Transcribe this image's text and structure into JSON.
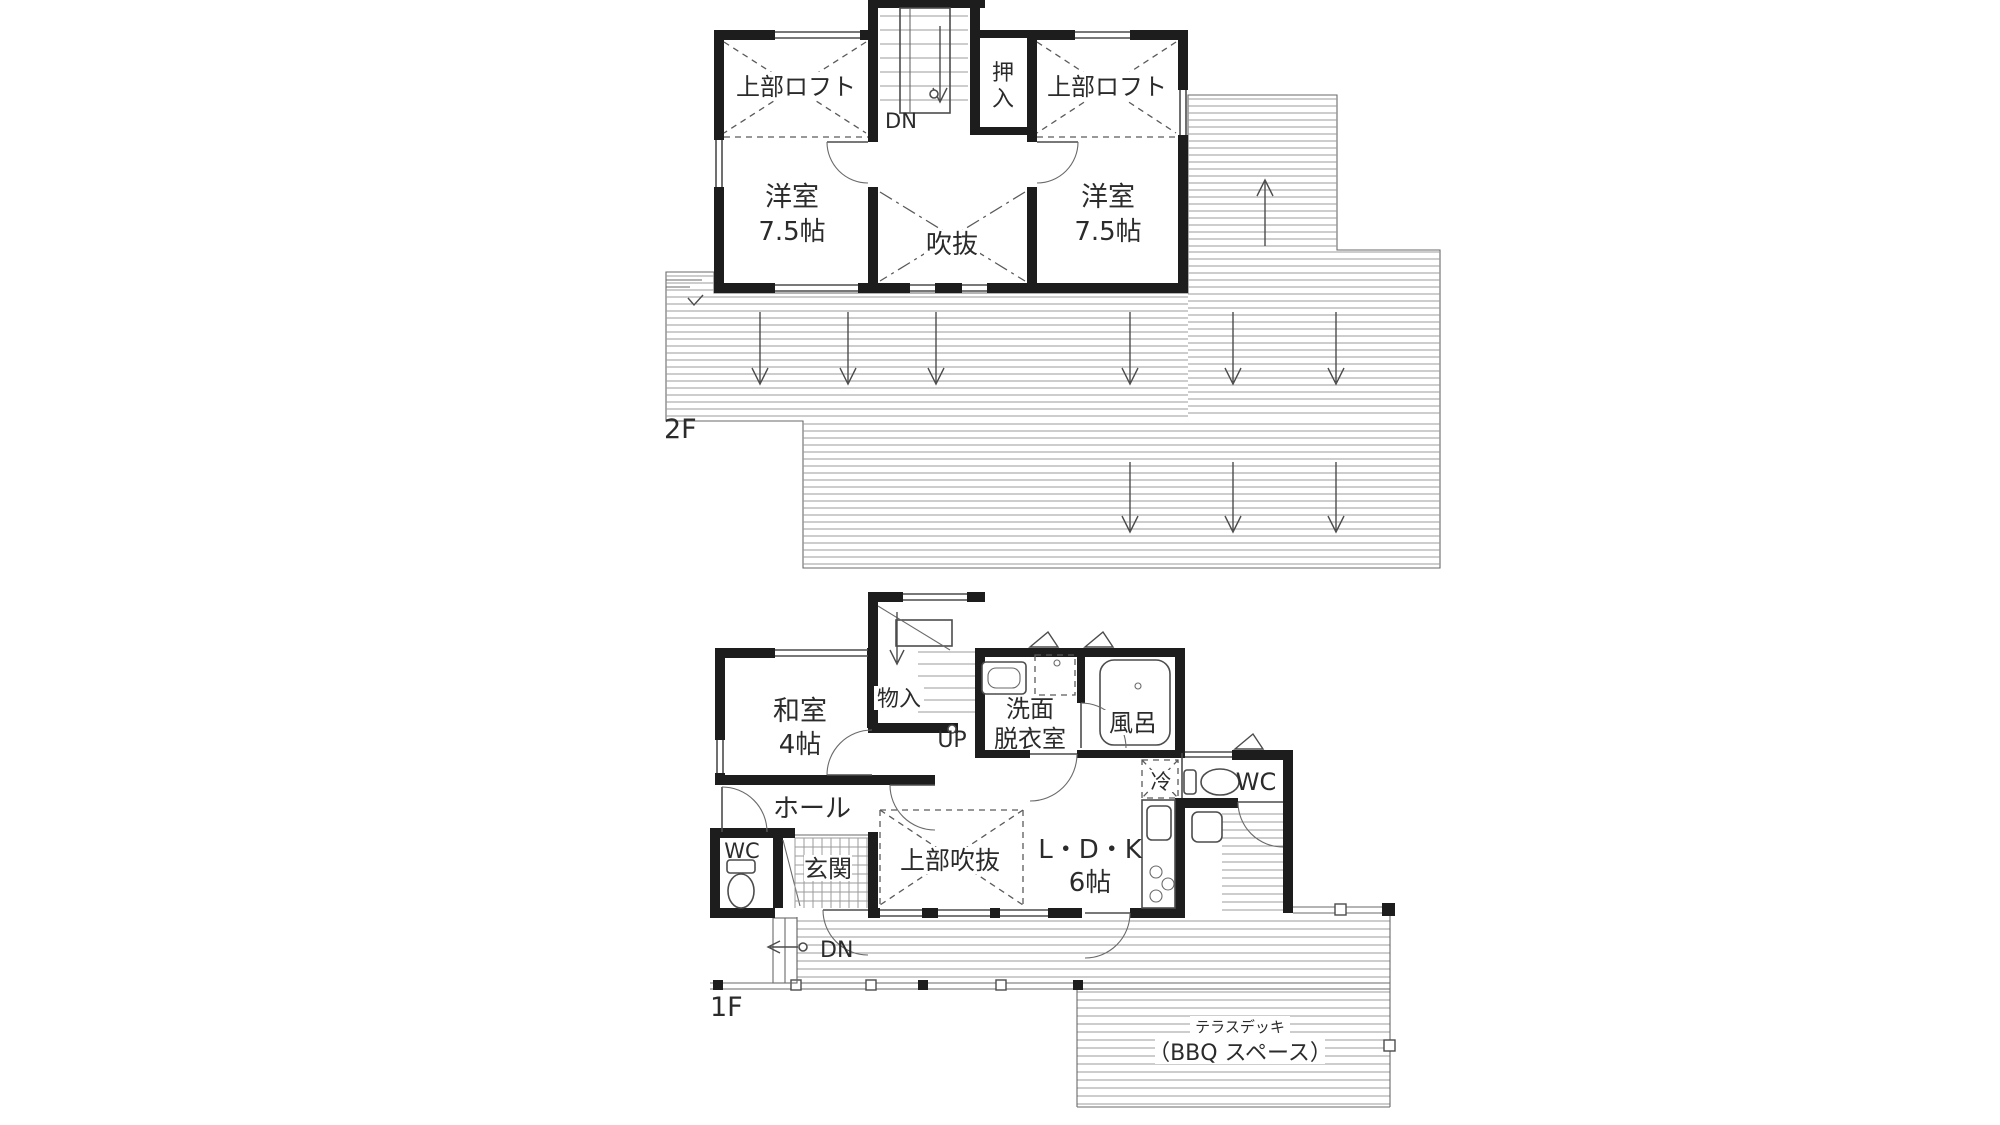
{
  "colors": {
    "wall": "#1d1d1d",
    "line": "#4c4c4c",
    "hatch": "#9b9b9b",
    "text": "#2b2b2b",
    "background": "#ffffff"
  },
  "floor2": {
    "floor_label": "2F",
    "loft_left": "上部ロフト",
    "western_room_left_name": "洋室",
    "western_room_left_size": "7.5帖",
    "stairs_down_label": "DN",
    "closet_char1": "押",
    "closet_char2": "入",
    "loft_right": "上部ロフト",
    "western_room_right_name": "洋室",
    "western_room_right_size": "7.5帖",
    "void_label": "吹抜"
  },
  "floor1": {
    "floor_label": "1F",
    "japanese_room_name": "和室",
    "japanese_room_size": "4帖",
    "storage_label": "物入",
    "stairs_up_label": "UP",
    "washroom_line1": "洗面",
    "washroom_line2": "脱衣室",
    "bath_label": "風呂",
    "fridge_label": "冷",
    "wc_right_label": "WC",
    "hall_label": "ホール",
    "wc_left_label": "WC",
    "entrance_label": "玄関",
    "void_above_label": "上部吹抜",
    "ldk_line1": "L・D・K",
    "ldk_line2": "6帖",
    "stairs_down_label": "DN",
    "terrace_line1": "テラスデッキ",
    "terrace_line2": "（BBQ スペース）"
  }
}
